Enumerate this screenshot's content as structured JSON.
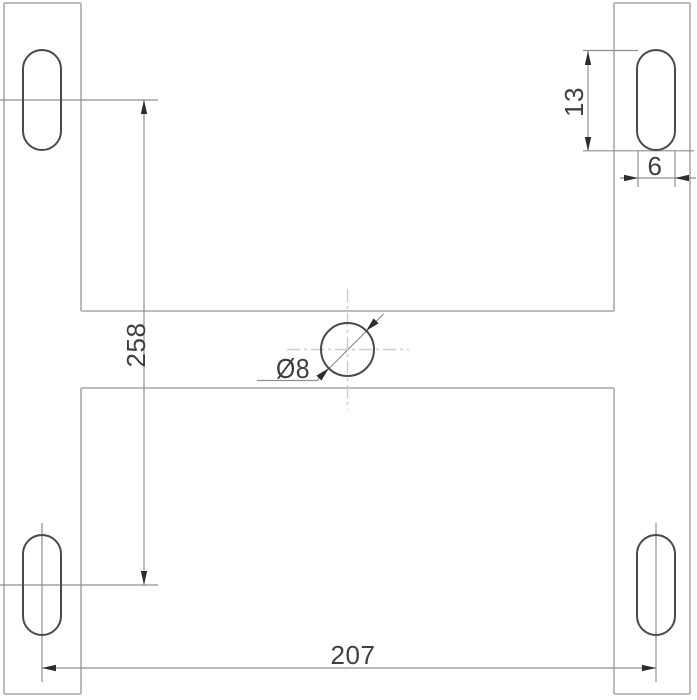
{
  "drawing": {
    "labels": {
      "vertical_hole_spacing": "258",
      "horizontal_hole_spacing": "207",
      "slot_length": "13",
      "slot_width": "6",
      "center_hole_diameter": "Ø8"
    },
    "colors": {
      "outline_stroke": "#b2b2b2",
      "feature_stroke": "#4a4a4a",
      "dimension_stroke": "#8f8f8f",
      "arrow_fill": "#2d2d2d",
      "text_fill": "#3f3f3f",
      "centerline_stroke": "#cccccc"
    }
  }
}
